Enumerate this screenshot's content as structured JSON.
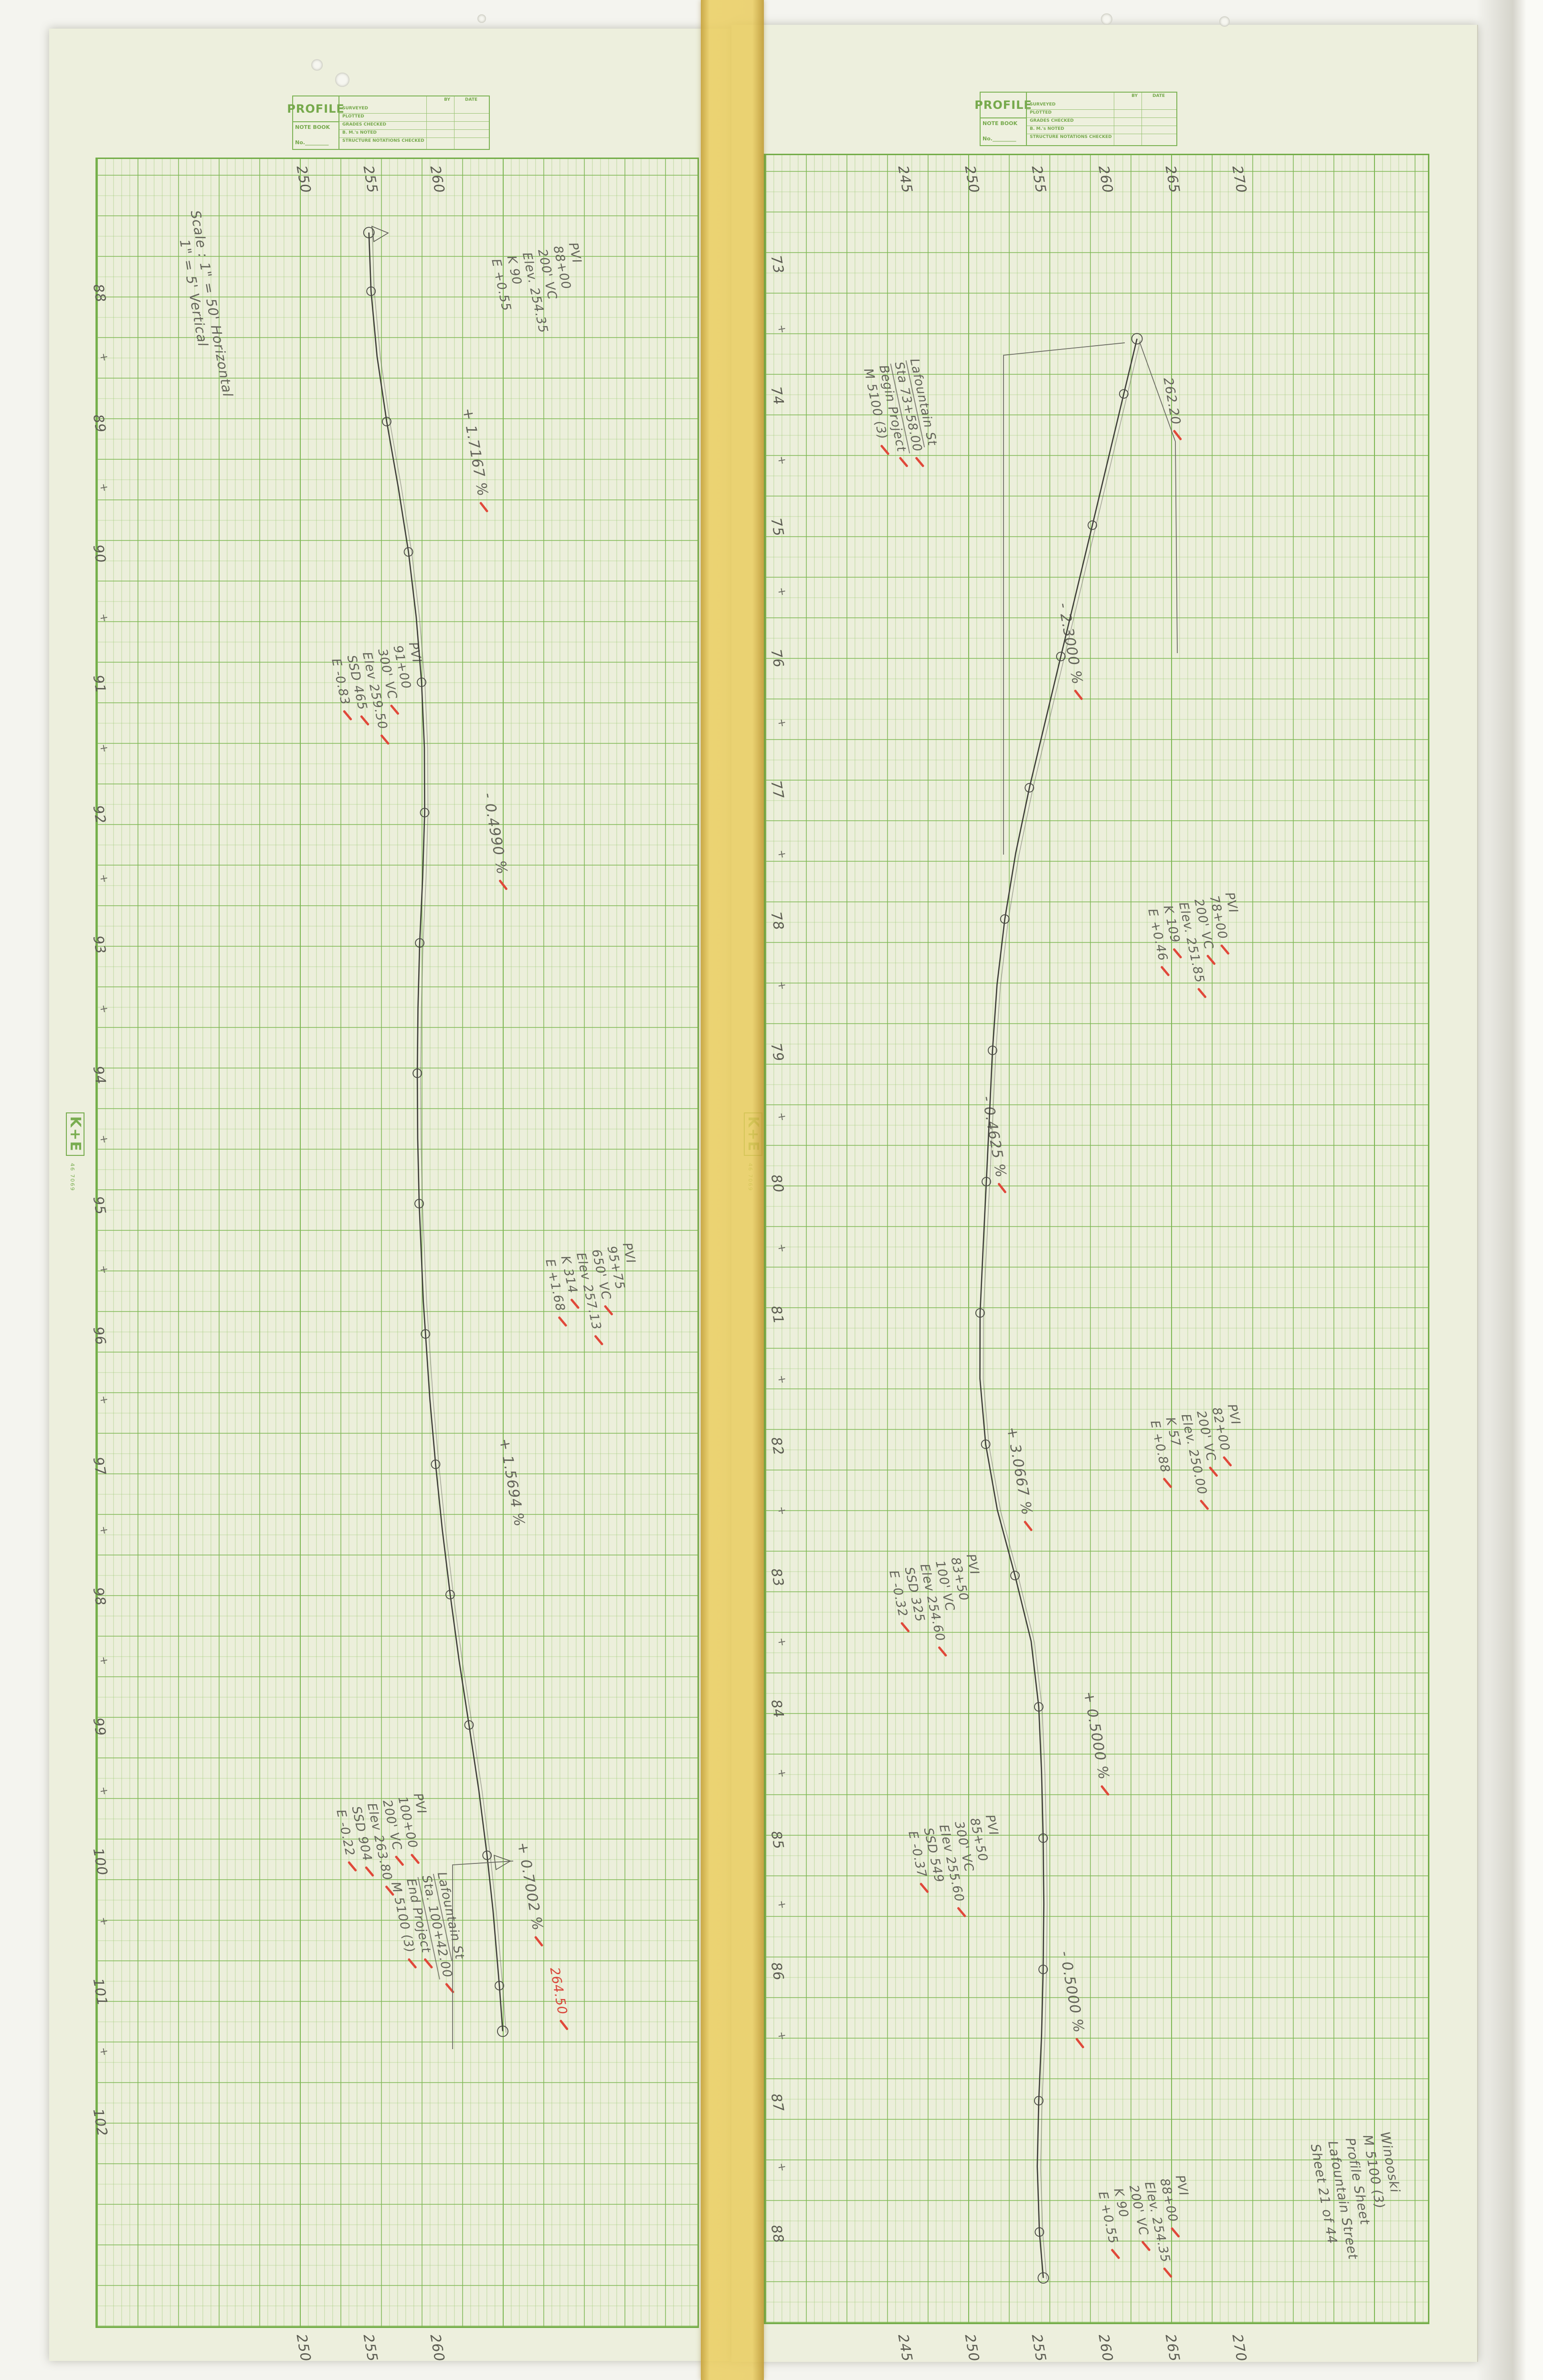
{
  "title_block": {
    "title": "PROFILE",
    "note_book": "NOTE BOOK",
    "no": "No.",
    "columns": [
      "BY",
      "DATE"
    ],
    "rows": [
      "SURVEYED",
      "PLOTTED",
      "GRADES CHECKED",
      "B. M.'s NOTED",
      "STRUCTURE NOTATIONS CHECKED"
    ]
  },
  "brand": {
    "logo": "K+E",
    "caption": "46 7069"
  },
  "scale_note": {
    "lines": [
      "Scale :  1\" = 50'  Horizontal",
      "1\" = 5'  Vertical"
    ]
  },
  "sheet_info": {
    "lines": [
      "Winooski",
      "M 5100 (3)",
      "Profile Sheet",
      "Lafountain Street",
      "Sheet 21 of 44"
    ]
  },
  "panels": [
    {
      "id": "left",
      "station_first": 88,
      "station_last": 102,
      "elevation_labels": [
        250,
        255,
        260
      ]
    },
    {
      "id": "right",
      "station_first": 73,
      "station_last": 88,
      "elevation_labels": [
        245,
        250,
        255,
        260,
        265,
        270
      ]
    }
  ],
  "annotations": [
    {
      "panel": "left",
      "x": 1215,
      "y": 505,
      "size": 26,
      "kind": "pvi",
      "lines": [
        {
          "t": "PVI"
        },
        {
          "t": "88+00"
        },
        {
          "t": "200' VC"
        },
        {
          "t": "Elev. 254.35"
        },
        {
          "t": "K 90"
        },
        {
          "t": "E +0.55"
        }
      ]
    },
    {
      "panel": "left",
      "x": 995,
      "y": 852,
      "size": 30,
      "kind": "grade",
      "lines": [
        {
          "t": "+ 1.7167 %",
          "check": true
        }
      ]
    },
    {
      "panel": "left",
      "x": 880,
      "y": 1342,
      "size": 26,
      "kind": "pvi",
      "lines": [
        {
          "t": "PVI"
        },
        {
          "t": "91+00"
        },
        {
          "t": "300' VC",
          "check": true
        },
        {
          "t": "Elev 259.50",
          "check": true
        },
        {
          "t": "SSD 465",
          "check": true
        },
        {
          "t": "E -0.83",
          "check": true
        }
      ]
    },
    {
      "panel": "left",
      "x": 1038,
      "y": 1658,
      "size": 30,
      "kind": "grade",
      "lines": [
        {
          "t": "- 0.4990 %",
          "check": true
        }
      ]
    },
    {
      "panel": "left",
      "x": 1328,
      "y": 2600,
      "size": 26,
      "kind": "pvi",
      "lines": [
        {
          "t": "PVI"
        },
        {
          "t": "95+75"
        },
        {
          "t": "650' VC",
          "check": true
        },
        {
          "t": "Elev 257.13",
          "check": true
        },
        {
          "t": "K 314",
          "check": true
        },
        {
          "t": "E +1.68",
          "check": true
        }
      ]
    },
    {
      "panel": "left",
      "x": 1072,
      "y": 3010,
      "size": 30,
      "kind": "grade",
      "lines": [
        {
          "t": "+ 1.5694 %"
        }
      ]
    },
    {
      "panel": "left",
      "x": 890,
      "y": 3753,
      "size": 26,
      "kind": "pvi",
      "lines": [
        {
          "t": "PVI"
        },
        {
          "t": "100+00",
          "check": true
        },
        {
          "t": "200' VC",
          "check": true
        },
        {
          "t": "Elev 263.80",
          "check": true
        },
        {
          "t": "SSD 904",
          "check": true
        },
        {
          "t": "E -0.22",
          "check": true
        }
      ]
    },
    {
      "panel": "left",
      "x": 1110,
      "y": 3856,
      "size": 30,
      "kind": "grade",
      "lines": [
        {
          "t": "+ 0.7002 %",
          "check": true
        }
      ]
    },
    {
      "panel": "left",
      "x": 940,
      "y": 3918,
      "size": 26,
      "kind": "street",
      "lines": [
        {
          "t": "Lafountain St",
          "underline": true
        },
        {
          "t": "Sta. 100+42.00",
          "underline": true,
          "check": true
        },
        {
          "t": "End Project",
          "check": true
        },
        {
          "t": "M 5100 (3)",
          "check": true
        }
      ]
    },
    {
      "panel": "left",
      "x": 1177,
      "y": 4118,
      "size": 27,
      "kind": "elev-callout",
      "red": true,
      "lines": [
        {
          "t": "264.50",
          "check": true
        }
      ]
    },
    {
      "panel": "right",
      "x": 1930,
      "y": 748,
      "size": 26,
      "kind": "street",
      "lines": [
        {
          "t": "Lafountain St",
          "underline": true
        },
        {
          "t": "Sta 73+58.00",
          "underline": true,
          "check": true
        },
        {
          "t": "Begin Project",
          "check": true
        },
        {
          "t": "M 5100 (3)",
          "check": true
        }
      ]
    },
    {
      "panel": "right",
      "x": 2462,
      "y": 788,
      "size": 27,
      "kind": "elev-callout",
      "lines": [
        {
          "t": "262.20",
          "check": true
        }
      ]
    },
    {
      "panel": "right",
      "x": 2243,
      "y": 1260,
      "size": 30,
      "kind": "grade",
      "lines": [
        {
          "t": "- 2.3000 %",
          "check": true
        }
      ]
    },
    {
      "panel": "right",
      "x": 2590,
      "y": 1866,
      "size": 26,
      "kind": "pvi",
      "lines": [
        {
          "t": "PVI"
        },
        {
          "t": "78+00",
          "check": true
        },
        {
          "t": "200' VC",
          "check": true
        },
        {
          "t": "Elev. 251.85",
          "check": true
        },
        {
          "t": "K 109",
          "check": true
        },
        {
          "t": "E +0.46",
          "check": true
        }
      ]
    },
    {
      "panel": "right",
      "x": 2083,
      "y": 2293,
      "size": 30,
      "kind": "grade",
      "lines": [
        {
          "t": "- 0.4625 %",
          "check": true
        }
      ]
    },
    {
      "panel": "right",
      "x": 2595,
      "y": 2938,
      "size": 26,
      "kind": "pvi",
      "lines": [
        {
          "t": "PVI"
        },
        {
          "t": "82+00",
          "check": true
        },
        {
          "t": "200' VC",
          "check": true
        },
        {
          "t": "Elev. 250.00",
          "check": true
        },
        {
          "t": "K 57"
        },
        {
          "t": "E +0.88",
          "check": true
        }
      ]
    },
    {
      "panel": "right",
      "x": 2135,
      "y": 2986,
      "size": 30,
      "kind": "grade",
      "lines": [
        {
          "t": "+ 3.0667 %",
          "check": true
        }
      ]
    },
    {
      "panel": "right",
      "x": 2048,
      "y": 3252,
      "size": 26,
      "kind": "pvi",
      "lines": [
        {
          "t": "PVI"
        },
        {
          "t": "83+50"
        },
        {
          "t": "100' VC"
        },
        {
          "t": "Elev 254.60",
          "check": true
        },
        {
          "t": "SSD 325"
        },
        {
          "t": "E -0.32",
          "check": true
        }
      ]
    },
    {
      "panel": "right",
      "x": 2296,
      "y": 3540,
      "size": 30,
      "kind": "grade",
      "lines": [
        {
          "t": "+ 0.5000 %",
          "check": true
        }
      ]
    },
    {
      "panel": "right",
      "x": 2088,
      "y": 3798,
      "size": 26,
      "kind": "pvi",
      "lines": [
        {
          "t": "PVI"
        },
        {
          "t": "85+50"
        },
        {
          "t": "300' VC"
        },
        {
          "t": "Elev 255.60",
          "check": true
        },
        {
          "t": "SSD 549"
        },
        {
          "t": "E -0.37",
          "check": true
        }
      ]
    },
    {
      "panel": "right",
      "x": 2246,
      "y": 4084,
      "size": 30,
      "kind": "grade",
      "lines": [
        {
          "t": "- 0.5000 %",
          "check": true
        }
      ]
    },
    {
      "panel": "right",
      "x": 2486,
      "y": 4553,
      "size": 26,
      "kind": "pvi",
      "lines": [
        {
          "t": "PVI"
        },
        {
          "t": "88+00",
          "check": true
        },
        {
          "t": "Elev. 254.35",
          "check": true
        },
        {
          "t": "200' VC",
          "check": true
        },
        {
          "t": "K 90"
        },
        {
          "t": "E +0.55",
          "check": true
        }
      ]
    }
  ],
  "chart_data": [
    {
      "type": "line",
      "panel": "left",
      "title": "Lafountain Street profile – left sheet (Sta 88+00 to 101+35)",
      "xlabel": "Station (100 ft)",
      "ylabel": "Elevation (ft)",
      "x_range": [
        88,
        102
      ],
      "y_range": [
        250,
        262.5
      ],
      "points": [
        [
          87.55,
          254.74
        ],
        [
          88,
          254.9
        ],
        [
          88.5,
          255.35
        ],
        [
          89,
          256.07
        ],
        [
          89.5,
          256.93
        ],
        [
          90,
          257.7
        ],
        [
          90.5,
          258.28
        ],
        [
          91,
          258.68
        ],
        [
          91.5,
          258.89
        ],
        [
          92,
          258.91
        ],
        [
          92.5,
          258.76
        ],
        [
          93,
          258.54
        ],
        [
          93.5,
          258.41
        ],
        [
          94,
          258.36
        ],
        [
          94.5,
          258.39
        ],
        [
          95,
          258.5
        ],
        [
          95.75,
          258.81
        ],
        [
          96.5,
          259.3
        ],
        [
          97,
          259.73
        ],
        [
          97.5,
          260.23
        ],
        [
          98,
          260.82
        ],
        [
          98.5,
          261.48
        ],
        [
          99,
          262.23
        ],
        [
          99.5,
          262.96
        ],
        [
          100,
          263.58
        ],
        [
          100.42,
          264.02
        ],
        [
          101,
          264.5
        ],
        [
          101.35,
          264.75
        ]
      ],
      "pvis": [
        {
          "station": "88+00",
          "elev": 254.35,
          "vc": "200' VC",
          "k": 90,
          "e": "+0.55"
        },
        {
          "station": "91+00",
          "elev": 259.5,
          "vc": "300' VC",
          "ssd": 465,
          "e": "-0.83"
        },
        {
          "station": "95+75",
          "elev": 257.13,
          "vc": "650' VC",
          "k": 314,
          "e": "+1.68"
        },
        {
          "station": "100+00",
          "elev": 263.8,
          "vc": "200' VC",
          "ssd": 904,
          "e": "-0.22"
        }
      ],
      "grades": [
        "+1.7167 %",
        "-0.4990 %",
        "+1.5694 %",
        "+0.7002 %"
      ],
      "end_note": {
        "label": "End Project",
        "station": "100+42.00",
        "elev_callout": "264.50"
      }
    },
    {
      "type": "line",
      "panel": "right",
      "title": "Lafountain Street profile – right sheet (Sta 73+58 to 88+00)",
      "xlabel": "Station (100 ft)",
      "ylabel": "Elevation (ft)",
      "x_range": [
        73,
        88
      ],
      "y_range": [
        245,
        270
      ],
      "points": [
        [
          73.58,
          262.2
        ],
        [
          74,
          261.21
        ],
        [
          75,
          258.86
        ],
        [
          76,
          256.5
        ],
        [
          77,
          254.15
        ],
        [
          77.5,
          253.12
        ],
        [
          78,
          252.31
        ],
        [
          78.5,
          251.73
        ],
        [
          79,
          251.39
        ],
        [
          79.5,
          251.16
        ],
        [
          80,
          250.93
        ],
        [
          80.5,
          250.69
        ],
        [
          81,
          250.46
        ],
        [
          81.5,
          250.45
        ],
        [
          82,
          250.88
        ],
        [
          82.5,
          251.75
        ],
        [
          83,
          253.07
        ],
        [
          83.5,
          254.28
        ],
        [
          84,
          254.85
        ],
        [
          84.5,
          255.06
        ],
        [
          85,
          255.18
        ],
        [
          85.5,
          255.23
        ],
        [
          86,
          255.18
        ],
        [
          86.5,
          255.06
        ],
        [
          87,
          254.85
        ],
        [
          87.5,
          254.74
        ],
        [
          88,
          254.9
        ],
        [
          88.35,
          255.19
        ]
      ],
      "pvis": [
        {
          "station": "78+00",
          "elev": 251.85,
          "vc": "200' VC",
          "k": 109,
          "e": "+0.46"
        },
        {
          "station": "82+00",
          "elev": 250.0,
          "vc": "200' VC",
          "k": 57,
          "e": "+0.88"
        },
        {
          "station": "83+50",
          "elev": 254.6,
          "vc": "100' VC",
          "ssd": 325,
          "e": "-0.32"
        },
        {
          "station": "85+50",
          "elev": 255.6,
          "vc": "300' VC",
          "ssd": 549,
          "e": "-0.37"
        },
        {
          "station": "88+00",
          "elev": 254.35,
          "vc": "200' VC",
          "k": 90,
          "e": "+0.55"
        }
      ],
      "grades": [
        "-2.3000 %",
        "-0.4625 %",
        "+3.0667 %",
        "+0.5000 %",
        "-0.5000 %"
      ],
      "begin_note": {
        "label": "Begin Project",
        "station": "73+58.00",
        "elev_callout": "262.20"
      }
    }
  ]
}
